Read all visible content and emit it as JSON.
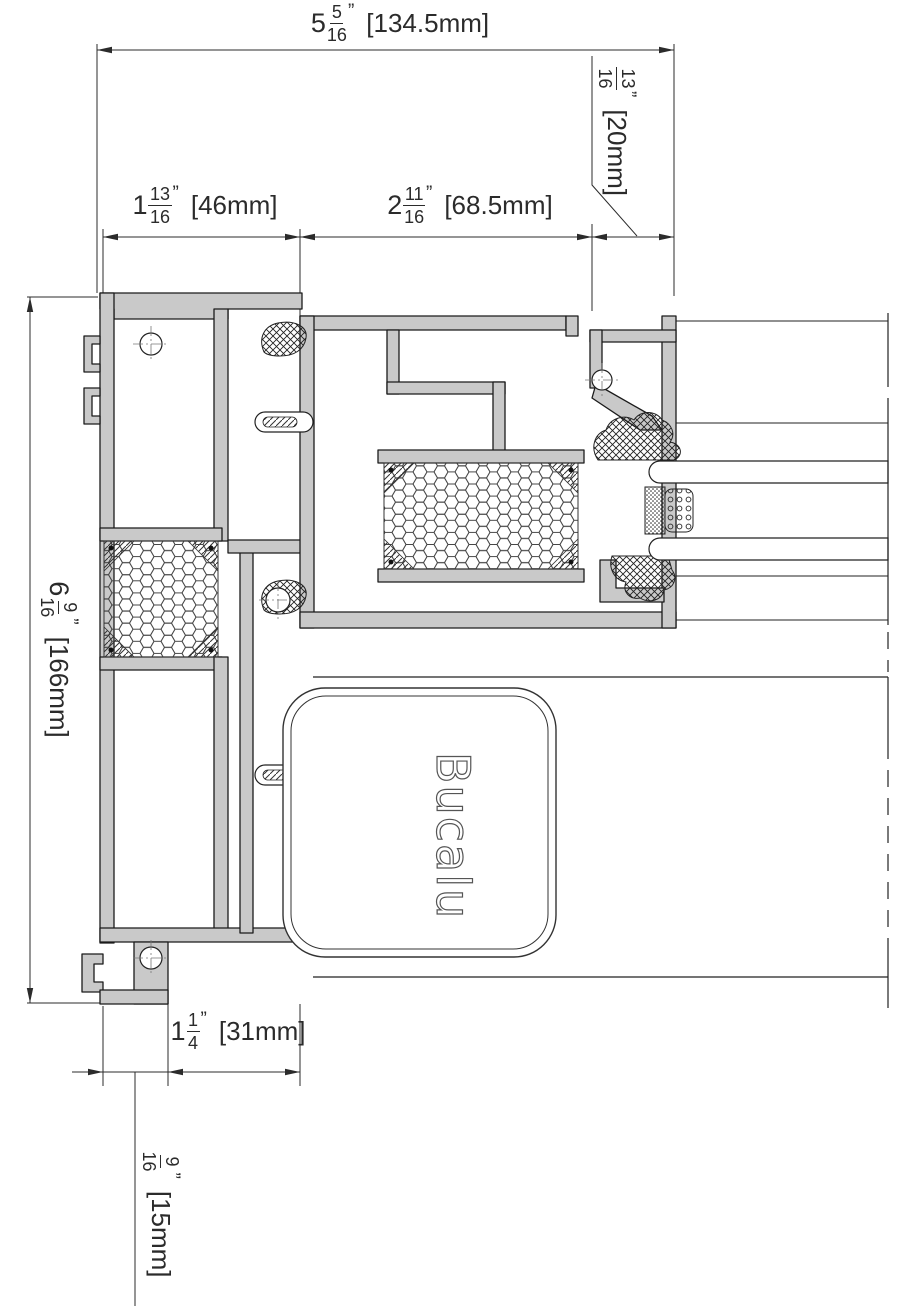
{
  "drawing": {
    "title": "Aluminium window frame cross-section",
    "brand_logo": "Bucalu"
  },
  "colors": {
    "profile_fill": "#c9c9c9",
    "outline": "#1b1b1b",
    "dimension_line": "#2b2b2b",
    "background": "#ffffff"
  },
  "dimensions": {
    "overall_width": {
      "whole": "5",
      "num": "5",
      "den": "16",
      "unit": "”",
      "metric": "[134.5mm]"
    },
    "edge_offset": {
      "whole": "",
      "num": "13",
      "den": "16",
      "unit": "”",
      "metric": "[20mm]"
    },
    "frame_depth": {
      "whole": "1",
      "num": "13",
      "den": "16",
      "unit": "”",
      "metric": "[46mm]"
    },
    "sash_depth": {
      "whole": "2",
      "num": "11",
      "den": "16",
      "unit": "”",
      "metric": "[68.5mm]"
    },
    "overall_height": {
      "whole": "6",
      "num": "9",
      "den": "16",
      "unit": "”",
      "metric": "[166mm]"
    },
    "bottom_width": {
      "whole": "1",
      "num": "1",
      "den": "4",
      "unit": "”",
      "metric": "[31mm]"
    },
    "foot_width": {
      "whole": "",
      "num": "9",
      "den": "16",
      "unit": "”",
      "metric": "[15mm]"
    }
  }
}
